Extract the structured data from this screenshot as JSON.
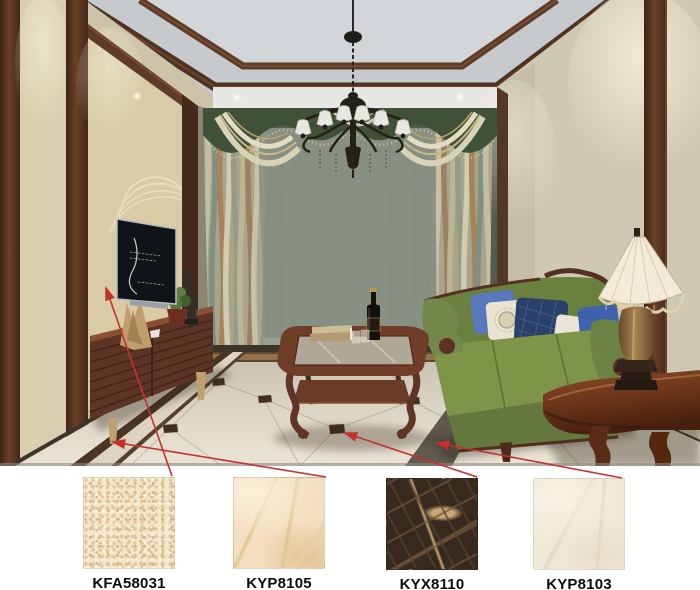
{
  "products": [
    {
      "code": "KFA58031",
      "applied_to": "left-wall-panel",
      "colors": [
        "#f4e6cb",
        "#e2c69b",
        "#d6b580",
        "#fdf6e6"
      ]
    },
    {
      "code": "KYP8105",
      "applied_to": "floor-tile-left",
      "colors": [
        "#f3dfc0",
        "#e9cfa6",
        "#e2c393",
        "#fbf0da"
      ]
    },
    {
      "code": "KYX8110",
      "applied_to": "floor-inlay-border",
      "colors": [
        "#37291d",
        "#564130",
        "#6e543a",
        "#c9ab72"
      ]
    },
    {
      "code": "KYP8103",
      "applied_to": "floor-tile-main",
      "colors": [
        "#f0e9d8",
        "#f8f2e4",
        "#e2d8bf",
        "#e9dfca"
      ]
    }
  ],
  "annotations": {
    "arrow_color": "#c5322d",
    "arrows": [
      {
        "from": [
          172,
          476
        ],
        "to": [
          106,
          288
        ],
        "target": "wall-panel"
      },
      {
        "from": [
          326,
          477
        ],
        "to": [
          113,
          442
        ],
        "target": "floor-left"
      },
      {
        "from": [
          477,
          477
        ],
        "to": [
          345,
          433
        ],
        "target": "floor-inlay"
      },
      {
        "from": [
          622,
          478
        ],
        "to": [
          437,
          443
        ],
        "target": "floor-main"
      }
    ]
  },
  "scene": {
    "key_colors": {
      "ceiling": "#c6cacd",
      "ceiling_center": "#d3d6d8",
      "left_wall_panel": "#d8cba6",
      "right_wall": "#cfc9b4",
      "wood_trim": "#5d3b28",
      "curtain_green": "#3f5138",
      "sheer": "#939e90",
      "sofa_green": "#7d9449",
      "floor_border": "#4a3526",
      "cabinet_wood": "#5d3526",
      "lamp_shade": "#f3ebd8"
    }
  }
}
